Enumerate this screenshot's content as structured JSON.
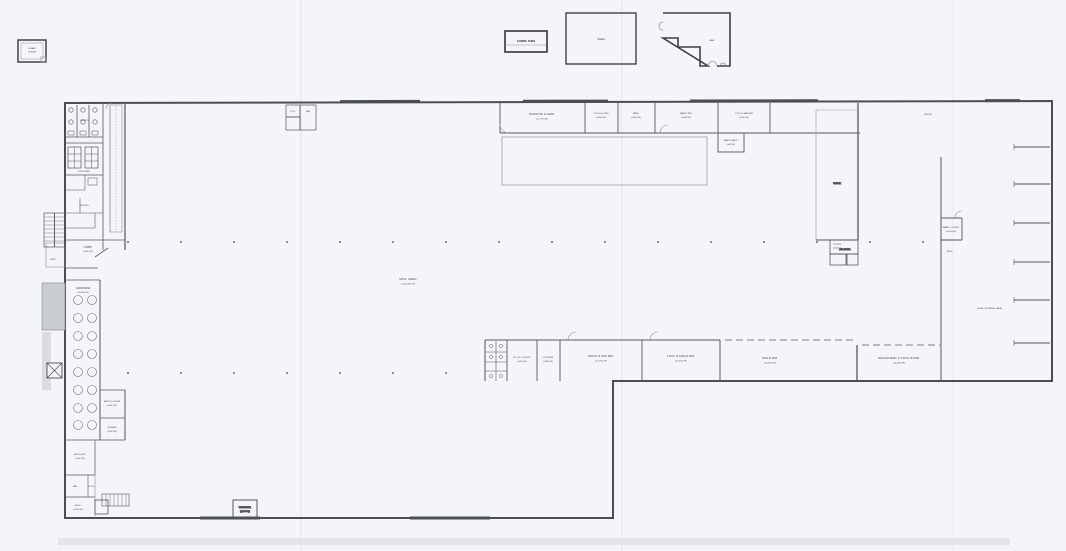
{
  "document": {
    "type": "scanned-floor-plan",
    "paper_color": "#f3f5f8",
    "ink_color": "#3c3e42",
    "wall_color": "#4a4d52",
    "light_line_color": "#8d9095",
    "shade_color": "#c9ccd1"
  },
  "outbuildings": {
    "guard": {
      "line1": "GUARD",
      "line2": "HOUSE"
    },
    "compressor": {
      "label": "COMPR. SHED"
    },
    "shed": {
      "label": "SHED"
    },
    "garage": {
      "label": "GAR."
    }
  },
  "main_area": {
    "label": "MFG. AREA",
    "area": "(±118,000 SF)"
  },
  "top_rooms": [
    {
      "label": "PACKING & SHIP.",
      "area": "(±1,750 SF)"
    },
    {
      "label": "TOOLS & DIES",
      "area": "(±400 SF)"
    },
    {
      "label": "PAINT",
      "area": "(±350 SF)"
    },
    {
      "label": "MAINT. RM.",
      "area": "(±500 SF)"
    },
    {
      "label": "TOOL & MASTER",
      "area": "(±900 SF)"
    },
    {
      "label": "PARTS VAULT",
      "area": "(±50 SF)"
    },
    {
      "label": "STOCK"
    },
    {
      "label": "OFFICE"
    }
  ],
  "top_block": {
    "a": "JAN.",
    "b": "TOIL."
  },
  "air_comp": {
    "label": "AIR COMP."
  },
  "right_side": {
    "maint_closet": {
      "label": "MAINT. CLOSET",
      "area": "(±100 SF)"
    },
    "elec": {
      "label": "ELEC."
    },
    "metal_panel": {
      "label": "EDGE OF METAL PANEL"
    }
  },
  "bottom_rooms": [
    {
      "label": "M. & W. TOILETS",
      "area": "(±550 SF)"
    },
    {
      "label": "LOCKERS",
      "area": "(±350 SF)"
    },
    {
      "label": "PAINT & MIX RM.",
      "area": "(±1,700 SF)"
    },
    {
      "label": "TOOL & MOLD RM.",
      "area": "(±1,500 SF)"
    },
    {
      "label": "MOLD RM.",
      "area": "(±3,000 SF)"
    },
    {
      "label": "MACHINERY & TOOL STOR.",
      "area": "(±1,800 SF)"
    }
  ],
  "waste": {
    "label": "WASTE RM.",
    "area": "(±150 SF)"
  },
  "left_wing": {
    "toilets": {
      "label": "TOILETS"
    },
    "lunch": {
      "label": "LUNCH RM."
    },
    "offices": {
      "label": "OFFICES"
    },
    "lobby": {
      "label": "LOBBY",
      "area": "(±350 SF)"
    },
    "vest": {
      "label": "VEST."
    },
    "cafeteria": {
      "label": "CAFETERIA",
      "area": "(±2,600 SF)"
    },
    "mens_locker": {
      "label": "MEN'S LOCKER",
      "area": "(±450 SF)"
    },
    "womens": {
      "label": "WOMEN",
      "area": "(±300 SF)"
    },
    "ac_equip": {
      "label": "A/C EQUIP.",
      "area": "(±500 SF)"
    },
    "jan": {
      "label": "JAN."
    },
    "stor": {
      "label": "STOR."
    },
    "elec": {
      "label": "ELEC.",
      "area": "(±150 SF)"
    }
  }
}
